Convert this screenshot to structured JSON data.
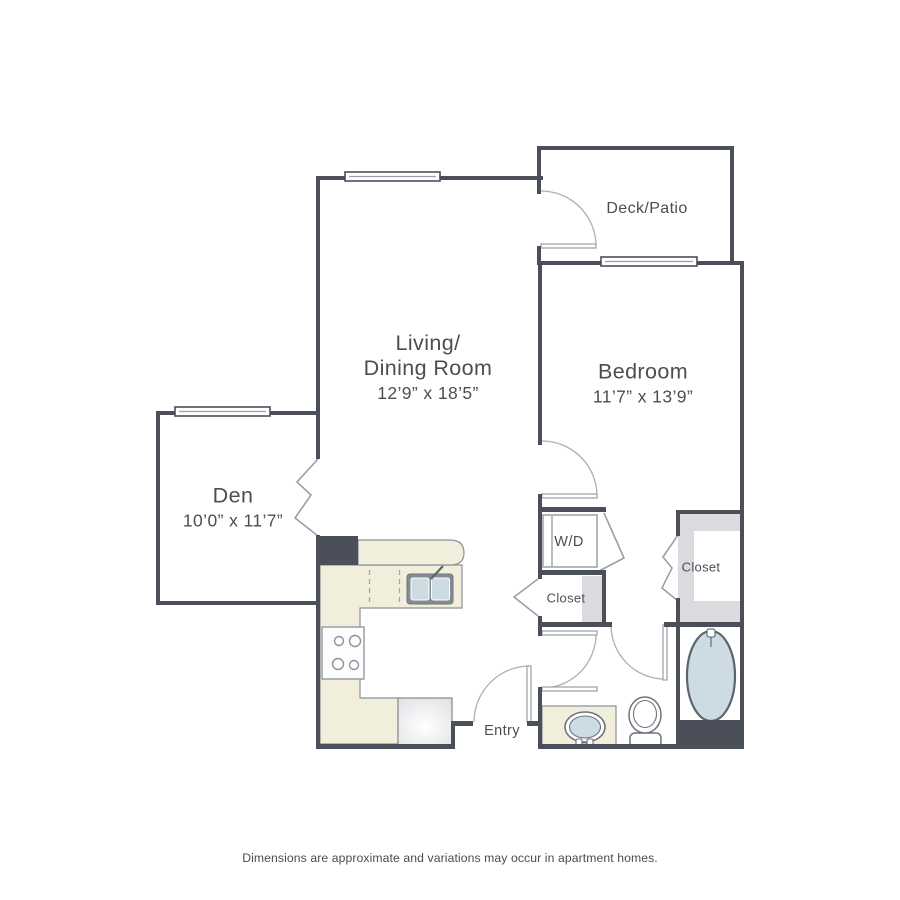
{
  "rooms": {
    "living": {
      "line1": "Living/",
      "line2": "Dining Room",
      "dims": "12’9” x 18’5”"
    },
    "bedroom": {
      "name": "Bedroom",
      "dims": "11’7” x 13’9”"
    },
    "den": {
      "name": "Den",
      "dims": "10’0” x 11’7”"
    },
    "deck": {
      "name": "Deck/Patio"
    }
  },
  "fixtures": {
    "washer_dryer_label": "W/D"
  },
  "closets": {
    "hall_label": "Closet",
    "bedroom_label": "Closet"
  },
  "entry": {
    "label": "Entry"
  },
  "footer": {
    "disclaimer": "Dimensions are approximate and variations may occur in apartment homes."
  },
  "colors": {
    "background": "#ffffff",
    "wall": "#4a4f59",
    "counter": "#f1eedb",
    "fixture_fill": "#ccdce2",
    "closet_fill": "#dbdbdf",
    "thin_line": "#9aa0a6",
    "text": "#4b4e53"
  }
}
